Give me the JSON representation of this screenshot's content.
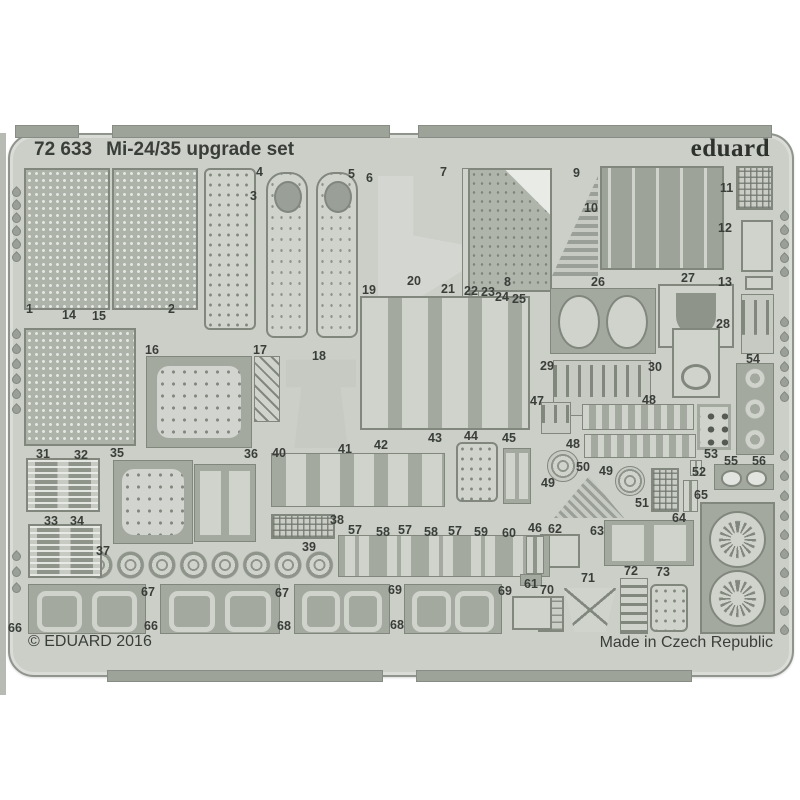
{
  "header": {
    "set_number": "72 633",
    "set_name": "Mi-24/35 upgrade set",
    "brand": "eduard"
  },
  "footer": {
    "copyright": "© EDUARD 2016",
    "origin": "Made in Czech Republic"
  },
  "colors": {
    "background": "#ffffff",
    "fret_base": "#cbcfc8",
    "fret_edge": "#8f948c",
    "part_dark": "#a4a9a0",
    "part_light": "#cfd3cc",
    "part_border": "#82877e",
    "text": "#3a3e39",
    "photo_edge": "#b7bbb4"
  },
  "fret": {
    "part_labels": [
      {
        "n": "1",
        "x": 26,
        "y": 303
      },
      {
        "n": "2",
        "x": 168,
        "y": 303
      },
      {
        "n": "3",
        "x": 250,
        "y": 190
      },
      {
        "n": "4",
        "x": 256,
        "y": 166
      },
      {
        "n": "5",
        "x": 348,
        "y": 168
      },
      {
        "n": "6",
        "x": 366,
        "y": 172
      },
      {
        "n": "7",
        "x": 440,
        "y": 166
      },
      {
        "n": "8",
        "x": 504,
        "y": 276
      },
      {
        "n": "9",
        "x": 573,
        "y": 167
      },
      {
        "n": "10",
        "x": 584,
        "y": 202
      },
      {
        "n": "11",
        "x": 720,
        "y": 182
      },
      {
        "n": "12",
        "x": 718,
        "y": 222
      },
      {
        "n": "13",
        "x": 718,
        "y": 276
      },
      {
        "n": "14",
        "x": 62,
        "y": 309
      },
      {
        "n": "15",
        "x": 92,
        "y": 310
      },
      {
        "n": "16",
        "x": 145,
        "y": 344
      },
      {
        "n": "17",
        "x": 253,
        "y": 344
      },
      {
        "n": "18",
        "x": 312,
        "y": 350
      },
      {
        "n": "19",
        "x": 362,
        "y": 284
      },
      {
        "n": "20",
        "x": 407,
        "y": 275
      },
      {
        "n": "21",
        "x": 441,
        "y": 283
      },
      {
        "n": "22",
        "x": 464,
        "y": 285
      },
      {
        "n": "23",
        "x": 481,
        "y": 286
      },
      {
        "n": "24",
        "x": 495,
        "y": 291
      },
      {
        "n": "25",
        "x": 512,
        "y": 293
      },
      {
        "n": "26",
        "x": 591,
        "y": 276
      },
      {
        "n": "27",
        "x": 681,
        "y": 272
      },
      {
        "n": "28",
        "x": 716,
        "y": 318
      },
      {
        "n": "29",
        "x": 540,
        "y": 360
      },
      {
        "n": "30",
        "x": 648,
        "y": 361
      },
      {
        "n": "31",
        "x": 36,
        "y": 448
      },
      {
        "n": "32",
        "x": 74,
        "y": 449
      },
      {
        "n": "33",
        "x": 44,
        "y": 515
      },
      {
        "n": "34",
        "x": 70,
        "y": 515
      },
      {
        "n": "35",
        "x": 110,
        "y": 447
      },
      {
        "n": "36",
        "x": 244,
        "y": 448
      },
      {
        "n": "37",
        "x": 96,
        "y": 545
      },
      {
        "n": "38",
        "x": 330,
        "y": 514
      },
      {
        "n": "39",
        "x": 302,
        "y": 541
      },
      {
        "n": "40",
        "x": 272,
        "y": 447
      },
      {
        "n": "41",
        "x": 338,
        "y": 443
      },
      {
        "n": "42",
        "x": 374,
        "y": 439
      },
      {
        "n": "43",
        "x": 428,
        "y": 432
      },
      {
        "n": "44",
        "x": 464,
        "y": 430
      },
      {
        "n": "45",
        "x": 502,
        "y": 432
      },
      {
        "n": "46",
        "x": 528,
        "y": 522
      },
      {
        "n": "47",
        "x": 530,
        "y": 395
      },
      {
        "n": "48",
        "x": 642,
        "y": 394
      },
      {
        "n": "48",
        "x": 566,
        "y": 438
      },
      {
        "n": "49",
        "x": 541,
        "y": 477
      },
      {
        "n": "49",
        "x": 599,
        "y": 465
      },
      {
        "n": "50",
        "x": 576,
        "y": 461
      },
      {
        "n": "51",
        "x": 635,
        "y": 497
      },
      {
        "n": "52",
        "x": 692,
        "y": 466
      },
      {
        "n": "53",
        "x": 704,
        "y": 448
      },
      {
        "n": "54",
        "x": 746,
        "y": 353
      },
      {
        "n": "55",
        "x": 724,
        "y": 455
      },
      {
        "n": "56",
        "x": 752,
        "y": 455
      },
      {
        "n": "57",
        "x": 348,
        "y": 524
      },
      {
        "n": "58",
        "x": 376,
        "y": 526
      },
      {
        "n": "57",
        "x": 398,
        "y": 524
      },
      {
        "n": "58",
        "x": 424,
        "y": 526
      },
      {
        "n": "57",
        "x": 448,
        "y": 525
      },
      {
        "n": "59",
        "x": 474,
        "y": 526
      },
      {
        "n": "60",
        "x": 502,
        "y": 527
      },
      {
        "n": "61",
        "x": 524,
        "y": 578
      },
      {
        "n": "62",
        "x": 548,
        "y": 523
      },
      {
        "n": "63",
        "x": 590,
        "y": 525
      },
      {
        "n": "64",
        "x": 672,
        "y": 512
      },
      {
        "n": "65",
        "x": 694,
        "y": 489
      },
      {
        "n": "66",
        "x": 8,
        "y": 622
      },
      {
        "n": "67",
        "x": 141,
        "y": 586
      },
      {
        "n": "66",
        "x": 144,
        "y": 620
      },
      {
        "n": "67",
        "x": 275,
        "y": 587
      },
      {
        "n": "68",
        "x": 277,
        "y": 620
      },
      {
        "n": "69",
        "x": 388,
        "y": 584
      },
      {
        "n": "68",
        "x": 390,
        "y": 619
      },
      {
        "n": "69",
        "x": 498,
        "y": 585
      },
      {
        "n": "70",
        "x": 540,
        "y": 584
      },
      {
        "n": "71",
        "x": 581,
        "y": 572
      },
      {
        "n": "72",
        "x": 624,
        "y": 565
      },
      {
        "n": "73",
        "x": 656,
        "y": 566
      }
    ],
    "shapes": [
      {
        "k": "mesh",
        "x": 24,
        "y": 168,
        "w": 86,
        "h": 142
      },
      {
        "k": "mesh",
        "x": 112,
        "y": 168,
        "w": 86,
        "h": 142
      },
      {
        "k": "dotted",
        "x": 204,
        "y": 168,
        "w": 52,
        "h": 162
      },
      {
        "k": "blade",
        "x": 266,
        "y": 172,
        "w": 42,
        "h": 166
      },
      {
        "k": "blade",
        "x": 316,
        "y": 172,
        "w": 42,
        "h": 166
      },
      {
        "k": "lshape",
        "x": 378,
        "y": 176,
        "w": 84,
        "h": 132
      },
      {
        "k": "stripv",
        "x": 462,
        "y": 168,
        "w": 17,
        "h": 150
      },
      {
        "k": "meshdark",
        "x": 468,
        "y": 168,
        "w": 84,
        "h": 124
      },
      {
        "k": "triangle",
        "x": 552,
        "y": 176,
        "w": 46,
        "h": 100
      },
      {
        "k": "hooks",
        "x": 600,
        "y": 166,
        "w": 124,
        "h": 104
      },
      {
        "k": "grid",
        "x": 736,
        "y": 166,
        "w": 37,
        "h": 44
      },
      {
        "k": "light",
        "x": 741,
        "y": 220,
        "w": 32,
        "h": 52
      },
      {
        "k": "light",
        "x": 745,
        "y": 276,
        "w": 28,
        "h": 14
      },
      {
        "k": "pins",
        "x": 741,
        "y": 294,
        "w": 33,
        "h": 60
      },
      {
        "k": "mesh",
        "x": 24,
        "y": 328,
        "w": 112,
        "h": 118
      },
      {
        "k": "framedots",
        "x": 146,
        "y": 356,
        "w": 106,
        "h": 92
      },
      {
        "k": "diag",
        "x": 254,
        "y": 356,
        "w": 26,
        "h": 66
      },
      {
        "k": "complex",
        "x": 286,
        "y": 356,
        "w": 70,
        "h": 92
      },
      {
        "k": "panelgroup",
        "x": 360,
        "y": 296,
        "w": 170,
        "h": 134
      },
      {
        "k": "ovals",
        "x": 550,
        "y": 288,
        "w": 106,
        "h": 66
      },
      {
        "k": "upanel",
        "x": 658,
        "y": 284,
        "w": 76,
        "h": 64
      },
      {
        "k": "pins",
        "x": 553,
        "y": 360,
        "w": 98,
        "h": 56
      },
      {
        "k": "ovalpanel",
        "x": 672,
        "y": 328,
        "w": 48,
        "h": 70
      },
      {
        "k": "ucolumn",
        "x": 736,
        "y": 363,
        "w": 38,
        "h": 92
      },
      {
        "k": "pins",
        "x": 541,
        "y": 402,
        "w": 30,
        "h": 32
      },
      {
        "k": "clips",
        "x": 582,
        "y": 404,
        "w": 112,
        "h": 26
      },
      {
        "k": "clips",
        "x": 584,
        "y": 434,
        "w": 112,
        "h": 24
      },
      {
        "k": "dots6",
        "x": 697,
        "y": 404,
        "w": 34,
        "h": 46
      },
      {
        "k": "disc",
        "x": 547,
        "y": 450,
        "w": 32,
        "h": 32
      },
      {
        "k": "disc",
        "x": 615,
        "y": 466,
        "w": 30,
        "h": 30
      },
      {
        "k": "trifla",
        "x": 554,
        "y": 476,
        "w": 70,
        "h": 42
      },
      {
        "k": "grid",
        "x": 651,
        "y": 468,
        "w": 28,
        "h": 44
      },
      {
        "k": "stripv",
        "x": 683,
        "y": 480,
        "w": 15,
        "h": 32
      },
      {
        "k": "stripv",
        "x": 690,
        "y": 460,
        "w": 12,
        "h": 16
      },
      {
        "k": "eyelets",
        "x": 714,
        "y": 464,
        "w": 60,
        "h": 26
      },
      {
        "k": "light",
        "x": 540,
        "y": 534,
        "w": 40,
        "h": 34
      },
      {
        "k": "panelpair",
        "x": 604,
        "y": 520,
        "w": 90,
        "h": 46
      },
      {
        "k": "dark",
        "x": 700,
        "y": 502,
        "w": 75,
        "h": 132
      },
      {
        "k": "rosette",
        "x": 709,
        "y": 511,
        "w": 57,
        "h": 57
      },
      {
        "k": "rosette",
        "x": 709,
        "y": 570,
        "w": 57,
        "h": 57
      },
      {
        "k": "hpart",
        "x": 538,
        "y": 596,
        "w": 26,
        "h": 36
      },
      {
        "k": "trap",
        "x": 564,
        "y": 588,
        "w": 52,
        "h": 44
      },
      {
        "k": "ladder",
        "x": 620,
        "y": 578,
        "w": 28,
        "h": 56
      },
      {
        "k": "dotted",
        "x": 650,
        "y": 584,
        "w": 38,
        "h": 48
      },
      {
        "k": "clamps",
        "x": 338,
        "y": 535,
        "w": 212,
        "h": 42
      },
      {
        "k": "stripv",
        "x": 526,
        "y": 536,
        "w": 18,
        "h": 38
      },
      {
        "k": "tiny",
        "x": 520,
        "y": 574,
        "w": 22,
        "h": 12
      },
      {
        "k": "grid",
        "x": 271,
        "y": 514,
        "w": 64,
        "h": 25
      },
      {
        "k": "discsrow",
        "x": 84,
        "y": 548,
        "w": 252,
        "h": 34
      },
      {
        "k": "group",
        "x": 271,
        "y": 453,
        "w": 174,
        "h": 54
      },
      {
        "k": "dotted",
        "x": 456,
        "y": 442,
        "w": 42,
        "h": 60
      },
      {
        "k": "panelpair",
        "x": 503,
        "y": 448,
        "w": 28,
        "h": 56
      },
      {
        "k": "framedots",
        "x": 113,
        "y": 460,
        "w": 80,
        "h": 84
      },
      {
        "k": "panelpair",
        "x": 194,
        "y": 464,
        "w": 62,
        "h": 78
      },
      {
        "k": "grille",
        "x": 26,
        "y": 458,
        "w": 74,
        "h": 54
      },
      {
        "k": "grille",
        "x": 28,
        "y": 524,
        "w": 74,
        "h": 54
      },
      {
        "k": "framespair",
        "x": 28,
        "y": 584,
        "w": 118,
        "h": 50
      },
      {
        "k": "framespair",
        "x": 160,
        "y": 584,
        "w": 120,
        "h": 50
      },
      {
        "k": "framespair",
        "x": 294,
        "y": 584,
        "w": 96,
        "h": 50
      },
      {
        "k": "framespair",
        "x": 404,
        "y": 584,
        "w": 98,
        "h": 50
      },
      {
        "k": "light",
        "x": 512,
        "y": 596,
        "w": 40,
        "h": 34
      }
    ],
    "tabs_top": [
      {
        "x": 15,
        "w": 62
      },
      {
        "x": 112,
        "w": 276
      },
      {
        "x": 418,
        "w": 352
      }
    ],
    "tabs_bottom": [
      {
        "x": 107,
        "w": 274
      },
      {
        "x": 416,
        "w": 274
      }
    ],
    "drop_columns": [
      {
        "x": 12,
        "y": 188,
        "count": 6,
        "gap": 13
      },
      {
        "x": 12,
        "y": 330,
        "count": 6,
        "gap": 15
      },
      {
        "x": 12,
        "y": 552,
        "count": 3,
        "gap": 16
      },
      {
        "x": 780,
        "y": 212,
        "count": 5,
        "gap": 14
      },
      {
        "x": 780,
        "y": 318,
        "count": 6,
        "gap": 15
      },
      {
        "x": 780,
        "y": 452,
        "count": 3,
        "gap": 20
      },
      {
        "x": 780,
        "y": 512,
        "count": 7,
        "gap": 19
      }
    ]
  }
}
